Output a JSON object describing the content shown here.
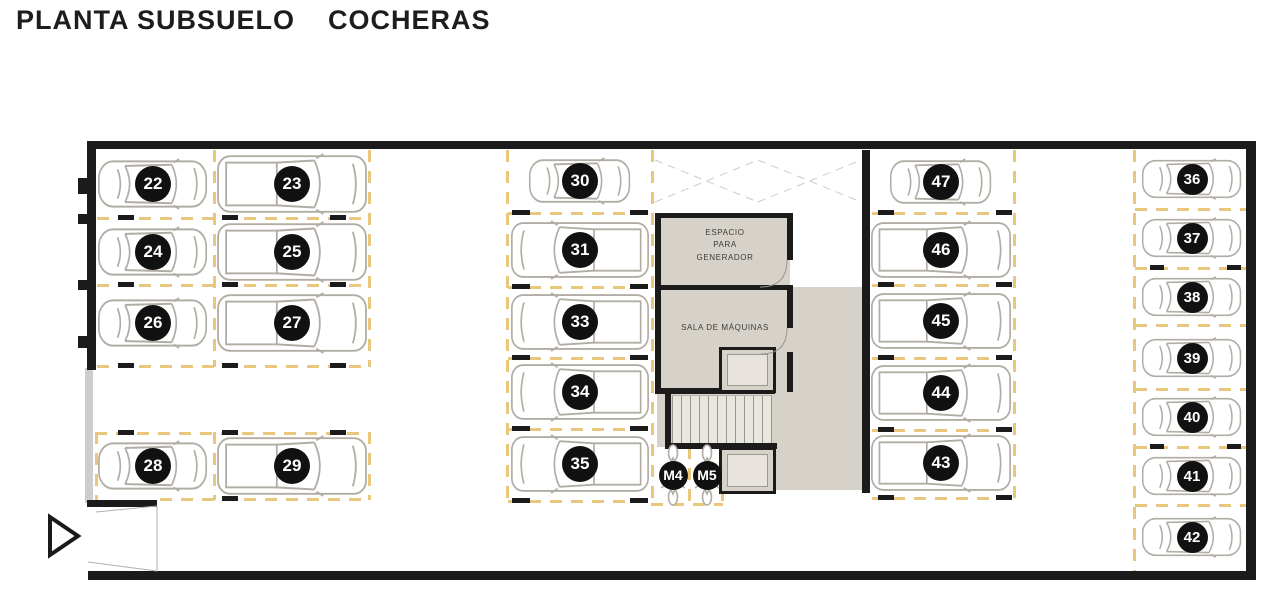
{
  "title": {
    "left": "PLANTA SUBSUELO",
    "right": "COCHERAS"
  },
  "rooms": {
    "generator": "ESPACIO\nPARA\nGENERADOR",
    "machines": "SALA DE MÁQUINAS"
  },
  "colors": {
    "wall": "#1b1b1b",
    "parking_line": "#e9c87e",
    "room_fill": "#d7d2c9",
    "car_outline": "#b2ada4",
    "badge_bg": "#111111",
    "badge_text": "#ffffff",
    "background": "#ffffff"
  },
  "plan": {
    "beige": [
      {
        "x": 657,
        "y": 215,
        "w": 205,
        "h": 275
      }
    ],
    "white": [
      {
        "x": 790,
        "y": 215,
        "w": 72,
        "h": 72
      },
      {
        "x": 651,
        "y": 447,
        "w": 72,
        "h": 58
      }
    ],
    "stairs": {
      "x": 672,
      "y": 395,
      "w": 100,
      "h": 48
    },
    "walls": [
      {
        "x": 88,
        "y": 141,
        "w": 1168,
        "h": 8
      },
      {
        "x": 88,
        "y": 571,
        "w": 1168,
        "h": 9
      },
      {
        "x": 1246,
        "y": 141,
        "w": 10,
        "h": 430
      },
      {
        "x": 87,
        "y": 141,
        "w": 9,
        "h": 229
      },
      {
        "x": 87,
        "y": 500,
        "w": 70,
        "h": 7
      },
      {
        "x": 655,
        "y": 213,
        "w": 138,
        "h": 5
      },
      {
        "x": 655,
        "y": 213,
        "w": 6,
        "h": 181
      },
      {
        "x": 655,
        "y": 285,
        "w": 138,
        "h": 5
      },
      {
        "x": 787,
        "y": 213,
        "w": 6,
        "h": 47
      },
      {
        "x": 787,
        "y": 290,
        "w": 6,
        "h": 38
      },
      {
        "x": 787,
        "y": 352,
        "w": 6,
        "h": 40
      },
      {
        "x": 655,
        "y": 388,
        "w": 120,
        "h": 6
      },
      {
        "x": 665,
        "y": 394,
        "w": 6,
        "h": 55
      },
      {
        "x": 665,
        "y": 443,
        "w": 112,
        "h": 6
      },
      {
        "x": 862,
        "y": 150,
        "w": 8,
        "h": 343
      }
    ],
    "graywalls": [
      {
        "x": 85,
        "y": 368,
        "w": 8,
        "h": 135
      }
    ],
    "elevators": [
      {
        "x": 719,
        "y": 347,
        "w": 57,
        "h": 46
      },
      {
        "x": 719,
        "y": 447,
        "w": 57,
        "h": 47
      }
    ],
    "dashes_h": [
      {
        "x": 97,
        "y": 217,
        "w": 271
      },
      {
        "x": 97,
        "y": 284,
        "w": 271
      },
      {
        "x": 97,
        "y": 365,
        "w": 271
      },
      {
        "x": 95,
        "y": 432,
        "w": 275
      },
      {
        "x": 160,
        "y": 498,
        "w": 210
      },
      {
        "x": 508,
        "y": 212,
        "w": 143
      },
      {
        "x": 508,
        "y": 286,
        "w": 143
      },
      {
        "x": 508,
        "y": 357,
        "w": 143
      },
      {
        "x": 508,
        "y": 428,
        "w": 143
      },
      {
        "x": 508,
        "y": 500,
        "w": 143
      },
      {
        "x": 651,
        "y": 503,
        "w": 72
      },
      {
        "x": 872,
        "y": 212,
        "w": 141
      },
      {
        "x": 872,
        "y": 284,
        "w": 141
      },
      {
        "x": 872,
        "y": 357,
        "w": 141
      },
      {
        "x": 872,
        "y": 429,
        "w": 141
      },
      {
        "x": 872,
        "y": 497,
        "w": 141
      },
      {
        "x": 1135,
        "y": 208,
        "w": 111
      },
      {
        "x": 1135,
        "y": 267,
        "w": 111
      },
      {
        "x": 1135,
        "y": 324,
        "w": 111
      },
      {
        "x": 1135,
        "y": 388,
        "w": 111
      },
      {
        "x": 1135,
        "y": 446,
        "w": 111
      },
      {
        "x": 1135,
        "y": 504,
        "w": 111
      }
    ],
    "dashes_v": [
      {
        "x": 213,
        "y": 150,
        "h": 217
      },
      {
        "x": 368,
        "y": 150,
        "h": 217
      },
      {
        "x": 95,
        "y": 432,
        "h": 68
      },
      {
        "x": 213,
        "y": 432,
        "h": 68
      },
      {
        "x": 368,
        "y": 432,
        "h": 68
      },
      {
        "x": 506,
        "y": 150,
        "h": 355
      },
      {
        "x": 651,
        "y": 150,
        "h": 355
      },
      {
        "x": 688,
        "y": 447,
        "h": 58
      },
      {
        "x": 721,
        "y": 447,
        "h": 58
      },
      {
        "x": 1013,
        "y": 150,
        "h": 348
      },
      {
        "x": 1133,
        "y": 150,
        "h": 421
      }
    ],
    "ticks": [
      {
        "x": 118,
        "y": 215,
        "w": 16,
        "h": 5
      },
      {
        "x": 222,
        "y": 215,
        "w": 16,
        "h": 5
      },
      {
        "x": 330,
        "y": 215,
        "w": 16,
        "h": 5
      },
      {
        "x": 118,
        "y": 282,
        "w": 16,
        "h": 5
      },
      {
        "x": 222,
        "y": 282,
        "w": 16,
        "h": 5
      },
      {
        "x": 330,
        "y": 282,
        "w": 16,
        "h": 5
      },
      {
        "x": 118,
        "y": 363,
        "w": 16,
        "h": 5
      },
      {
        "x": 222,
        "y": 363,
        "w": 16,
        "h": 5
      },
      {
        "x": 330,
        "y": 363,
        "w": 16,
        "h": 5
      },
      {
        "x": 118,
        "y": 430,
        "w": 16,
        "h": 5
      },
      {
        "x": 222,
        "y": 430,
        "w": 16,
        "h": 5
      },
      {
        "x": 330,
        "y": 430,
        "w": 16,
        "h": 5
      },
      {
        "x": 222,
        "y": 496,
        "w": 16,
        "h": 5
      },
      {
        "x": 512,
        "y": 210,
        "w": 18,
        "h": 5
      },
      {
        "x": 630,
        "y": 210,
        "w": 18,
        "h": 5
      },
      {
        "x": 512,
        "y": 284,
        "w": 18,
        "h": 5
      },
      {
        "x": 630,
        "y": 284,
        "w": 18,
        "h": 5
      },
      {
        "x": 512,
        "y": 355,
        "w": 18,
        "h": 5
      },
      {
        "x": 630,
        "y": 355,
        "w": 18,
        "h": 5
      },
      {
        "x": 512,
        "y": 426,
        "w": 18,
        "h": 5
      },
      {
        "x": 630,
        "y": 426,
        "w": 18,
        "h": 5
      },
      {
        "x": 512,
        "y": 498,
        "w": 18,
        "h": 5
      },
      {
        "x": 630,
        "y": 498,
        "w": 18,
        "h": 5
      },
      {
        "x": 878,
        "y": 210,
        "w": 16,
        "h": 5
      },
      {
        "x": 996,
        "y": 210,
        "w": 16,
        "h": 5
      },
      {
        "x": 878,
        "y": 282,
        "w": 16,
        "h": 5
      },
      {
        "x": 996,
        "y": 282,
        "w": 16,
        "h": 5
      },
      {
        "x": 878,
        "y": 355,
        "w": 16,
        "h": 5
      },
      {
        "x": 996,
        "y": 355,
        "w": 16,
        "h": 5
      },
      {
        "x": 878,
        "y": 427,
        "w": 16,
        "h": 5
      },
      {
        "x": 996,
        "y": 427,
        "w": 16,
        "h": 5
      },
      {
        "x": 878,
        "y": 495,
        "w": 16,
        "h": 5
      },
      {
        "x": 996,
        "y": 495,
        "w": 16,
        "h": 5
      },
      {
        "x": 1150,
        "y": 265,
        "w": 14,
        "h": 5
      },
      {
        "x": 1227,
        "y": 265,
        "w": 14,
        "h": 5
      },
      {
        "x": 1150,
        "y": 444,
        "w": 14,
        "h": 5
      },
      {
        "x": 1227,
        "y": 444,
        "w": 14,
        "h": 5
      },
      {
        "x": 78,
        "y": 178,
        "w": 10,
        "h": 16
      },
      {
        "x": 78,
        "y": 214,
        "w": 10,
        "h": 10
      },
      {
        "x": 78,
        "y": 280,
        "w": 10,
        "h": 10
      },
      {
        "x": 78,
        "y": 336,
        "w": 10,
        "h": 12
      }
    ],
    "spots": [
      {
        "label": "22",
        "cx": 153,
        "cy": 184,
        "v": "sedan",
        "w": 112,
        "h": 52,
        "b": 36
      },
      {
        "label": "23",
        "cx": 292,
        "cy": 184,
        "v": "truck",
        "w": 152,
        "h": 62,
        "b": 36
      },
      {
        "label": "24",
        "cx": 153,
        "cy": 252,
        "v": "sedan",
        "w": 112,
        "h": 52,
        "b": 36
      },
      {
        "label": "25",
        "cx": 292,
        "cy": 252,
        "v": "truck",
        "w": 152,
        "h": 62,
        "b": 36
      },
      {
        "label": "26",
        "cx": 153,
        "cy": 323,
        "v": "sedan",
        "w": 112,
        "h": 52,
        "b": 36
      },
      {
        "label": "27",
        "cx": 292,
        "cy": 323,
        "v": "truck",
        "w": 152,
        "h": 62,
        "b": 36
      },
      {
        "label": "28",
        "cx": 153,
        "cy": 466,
        "v": "sedan",
        "w": 112,
        "h": 52,
        "b": 36
      },
      {
        "label": "29",
        "cx": 292,
        "cy": 466,
        "v": "truck",
        "w": 152,
        "h": 62,
        "b": 36
      },
      {
        "label": "30",
        "cx": 580,
        "cy": 181,
        "v": "sedan",
        "w": 104,
        "h": 48,
        "b": 36
      },
      {
        "label": "31",
        "cx": 580,
        "cy": 250,
        "v": "truck",
        "w": 140,
        "h": 60,
        "b": 36,
        "f": 1
      },
      {
        "label": "33",
        "cx": 580,
        "cy": 322,
        "v": "truck",
        "w": 140,
        "h": 60,
        "b": 36,
        "f": 1
      },
      {
        "label": "34",
        "cx": 580,
        "cy": 392,
        "v": "truck",
        "w": 140,
        "h": 60,
        "b": 36,
        "f": 1
      },
      {
        "label": "35",
        "cx": 580,
        "cy": 464,
        "v": "truck",
        "w": 140,
        "h": 60,
        "b": 36,
        "f": 1
      },
      {
        "label": "M4",
        "cx": 673,
        "cy": 475,
        "v": "moto",
        "w": 30,
        "h": 62,
        "b": 29
      },
      {
        "label": "M5",
        "cx": 707,
        "cy": 475,
        "v": "moto",
        "w": 30,
        "h": 62,
        "b": 29
      },
      {
        "label": "47",
        "cx": 941,
        "cy": 182,
        "v": "sedan",
        "w": 104,
        "h": 48,
        "b": 36
      },
      {
        "label": "46",
        "cx": 941,
        "cy": 250,
        "v": "truck",
        "w": 142,
        "h": 60,
        "b": 36
      },
      {
        "label": "45",
        "cx": 941,
        "cy": 321,
        "v": "truck",
        "w": 142,
        "h": 60,
        "b": 36
      },
      {
        "label": "44",
        "cx": 941,
        "cy": 393,
        "v": "truck",
        "w": 142,
        "h": 60,
        "b": 36
      },
      {
        "label": "43",
        "cx": 941,
        "cy": 463,
        "v": "truck",
        "w": 142,
        "h": 60,
        "b": 36
      },
      {
        "label": "36",
        "cx": 1192,
        "cy": 179,
        "v": "sedan",
        "w": 102,
        "h": 42,
        "b": 31
      },
      {
        "label": "37",
        "cx": 1192,
        "cy": 238,
        "v": "sedan",
        "w": 102,
        "h": 42,
        "b": 31
      },
      {
        "label": "38",
        "cx": 1192,
        "cy": 297,
        "v": "sedan",
        "w": 102,
        "h": 42,
        "b": 31
      },
      {
        "label": "39",
        "cx": 1192,
        "cy": 358,
        "v": "sedan",
        "w": 102,
        "h": 42,
        "b": 31
      },
      {
        "label": "40",
        "cx": 1192,
        "cy": 417,
        "v": "sedan",
        "w": 102,
        "h": 42,
        "b": 31
      },
      {
        "label": "41",
        "cx": 1192,
        "cy": 476,
        "v": "sedan",
        "w": 102,
        "h": 42,
        "b": 31
      },
      {
        "label": "42",
        "cx": 1192,
        "cy": 537,
        "v": "sedan",
        "w": 102,
        "h": 42,
        "b": 31
      }
    ]
  }
}
